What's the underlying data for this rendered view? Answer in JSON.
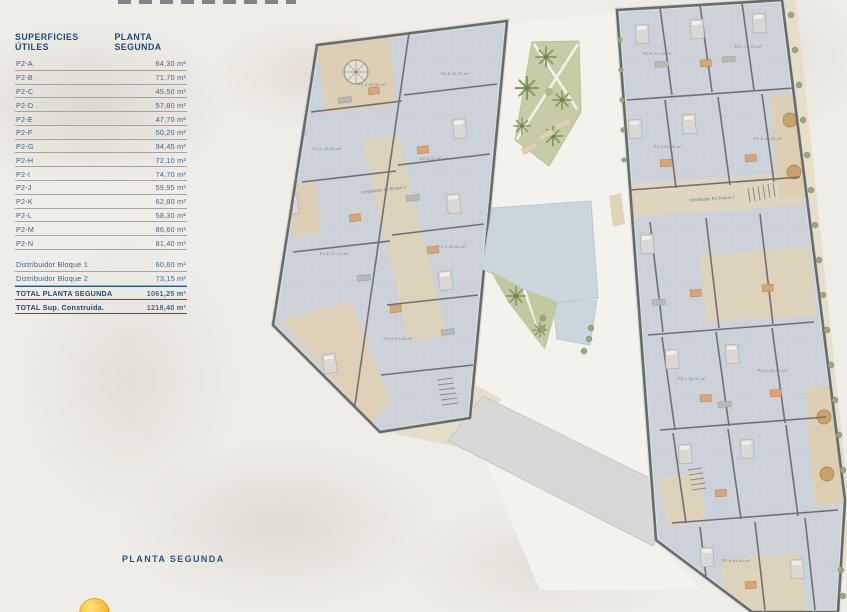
{
  "legend_table": {
    "col1_header": "SUPERFICIES ÚTILES",
    "col2_header": "PLANTA SEGUNDA",
    "unit_rows": [
      {
        "label": "P2-A",
        "value": "64,30 m²"
      },
      {
        "label": "P2-B",
        "value": "71,70 m²"
      },
      {
        "label": "P2-C",
        "value": "45,50 m²"
      },
      {
        "label": "P2-D",
        "value": "57,80 m²"
      },
      {
        "label": "P2-E",
        "value": "47,70 m²"
      },
      {
        "label": "P2-F",
        "value": "50,20 m²"
      },
      {
        "label": "P2-G",
        "value": "94,45 m²"
      },
      {
        "label": "P2-H",
        "value": "72,10 m²"
      },
      {
        "label": "P2-I",
        "value": "74,70 m²"
      },
      {
        "label": "P2-J",
        "value": "59,95 m²"
      },
      {
        "label": "P2-K",
        "value": "62,80 m²"
      },
      {
        "label": "P2-L",
        "value": "58,30 m²"
      },
      {
        "label": "P2-M",
        "value": "86,60 m²"
      },
      {
        "label": "P2-N",
        "value": "81,40 m²"
      }
    ],
    "distributor_rows": [
      {
        "label": "Distribuidor Bloque 1",
        "value": "60,60 m²"
      },
      {
        "label": "Distribuidor Bloque 2",
        "value": "73,15 m²"
      }
    ],
    "total_rows": [
      {
        "label": "TOTAL PLANTA SEGUNDA",
        "value": "1061,25 m²"
      },
      {
        "label": "TOTAL Sup. Construida.",
        "value": "1218,40 m²"
      }
    ]
  },
  "footer": {
    "caption": "PLANTA SEGUNDA"
  },
  "plan": {
    "rooms": [
      {
        "label": "P2-A  64,30 m²"
      },
      {
        "label": "P2-B  71,70 m²"
      },
      {
        "label": "P2-C  45,50 m²"
      },
      {
        "label": "P2-D  57,80 m²"
      },
      {
        "label": "P2-E  47,70 m²"
      },
      {
        "label": "P2-F  50,20 m²"
      },
      {
        "label": "P2-G  94,45 m²"
      },
      {
        "label": "P2-H  72,10 m²"
      },
      {
        "label": "P2-I  74,70 m²"
      },
      {
        "label": "P2-J  59,95 m²"
      },
      {
        "label": "P2-K  62,80 m²"
      },
      {
        "label": "P2-L  58,30 m²"
      },
      {
        "label": "P2-M  86,60 m²"
      },
      {
        "label": "P2-N  81,40 m²"
      }
    ],
    "distributors": [
      {
        "label": "Distribuidor P2 Bloque 1"
      },
      {
        "label": "Distribuidor P2 Bloque 2"
      }
    ]
  },
  "colors": {
    "accent_navy": "#1d4d7c",
    "floor_gray_blue": "#cbd1d8",
    "wall_gray": "#6a6a6a",
    "terrace_tan": "#dccfb4",
    "garden_green": "#c6cda6",
    "pool_blue": "#c9d6db",
    "walkway_gray": "#d8d8d6",
    "sun_yellow": "#f6bb33"
  }
}
